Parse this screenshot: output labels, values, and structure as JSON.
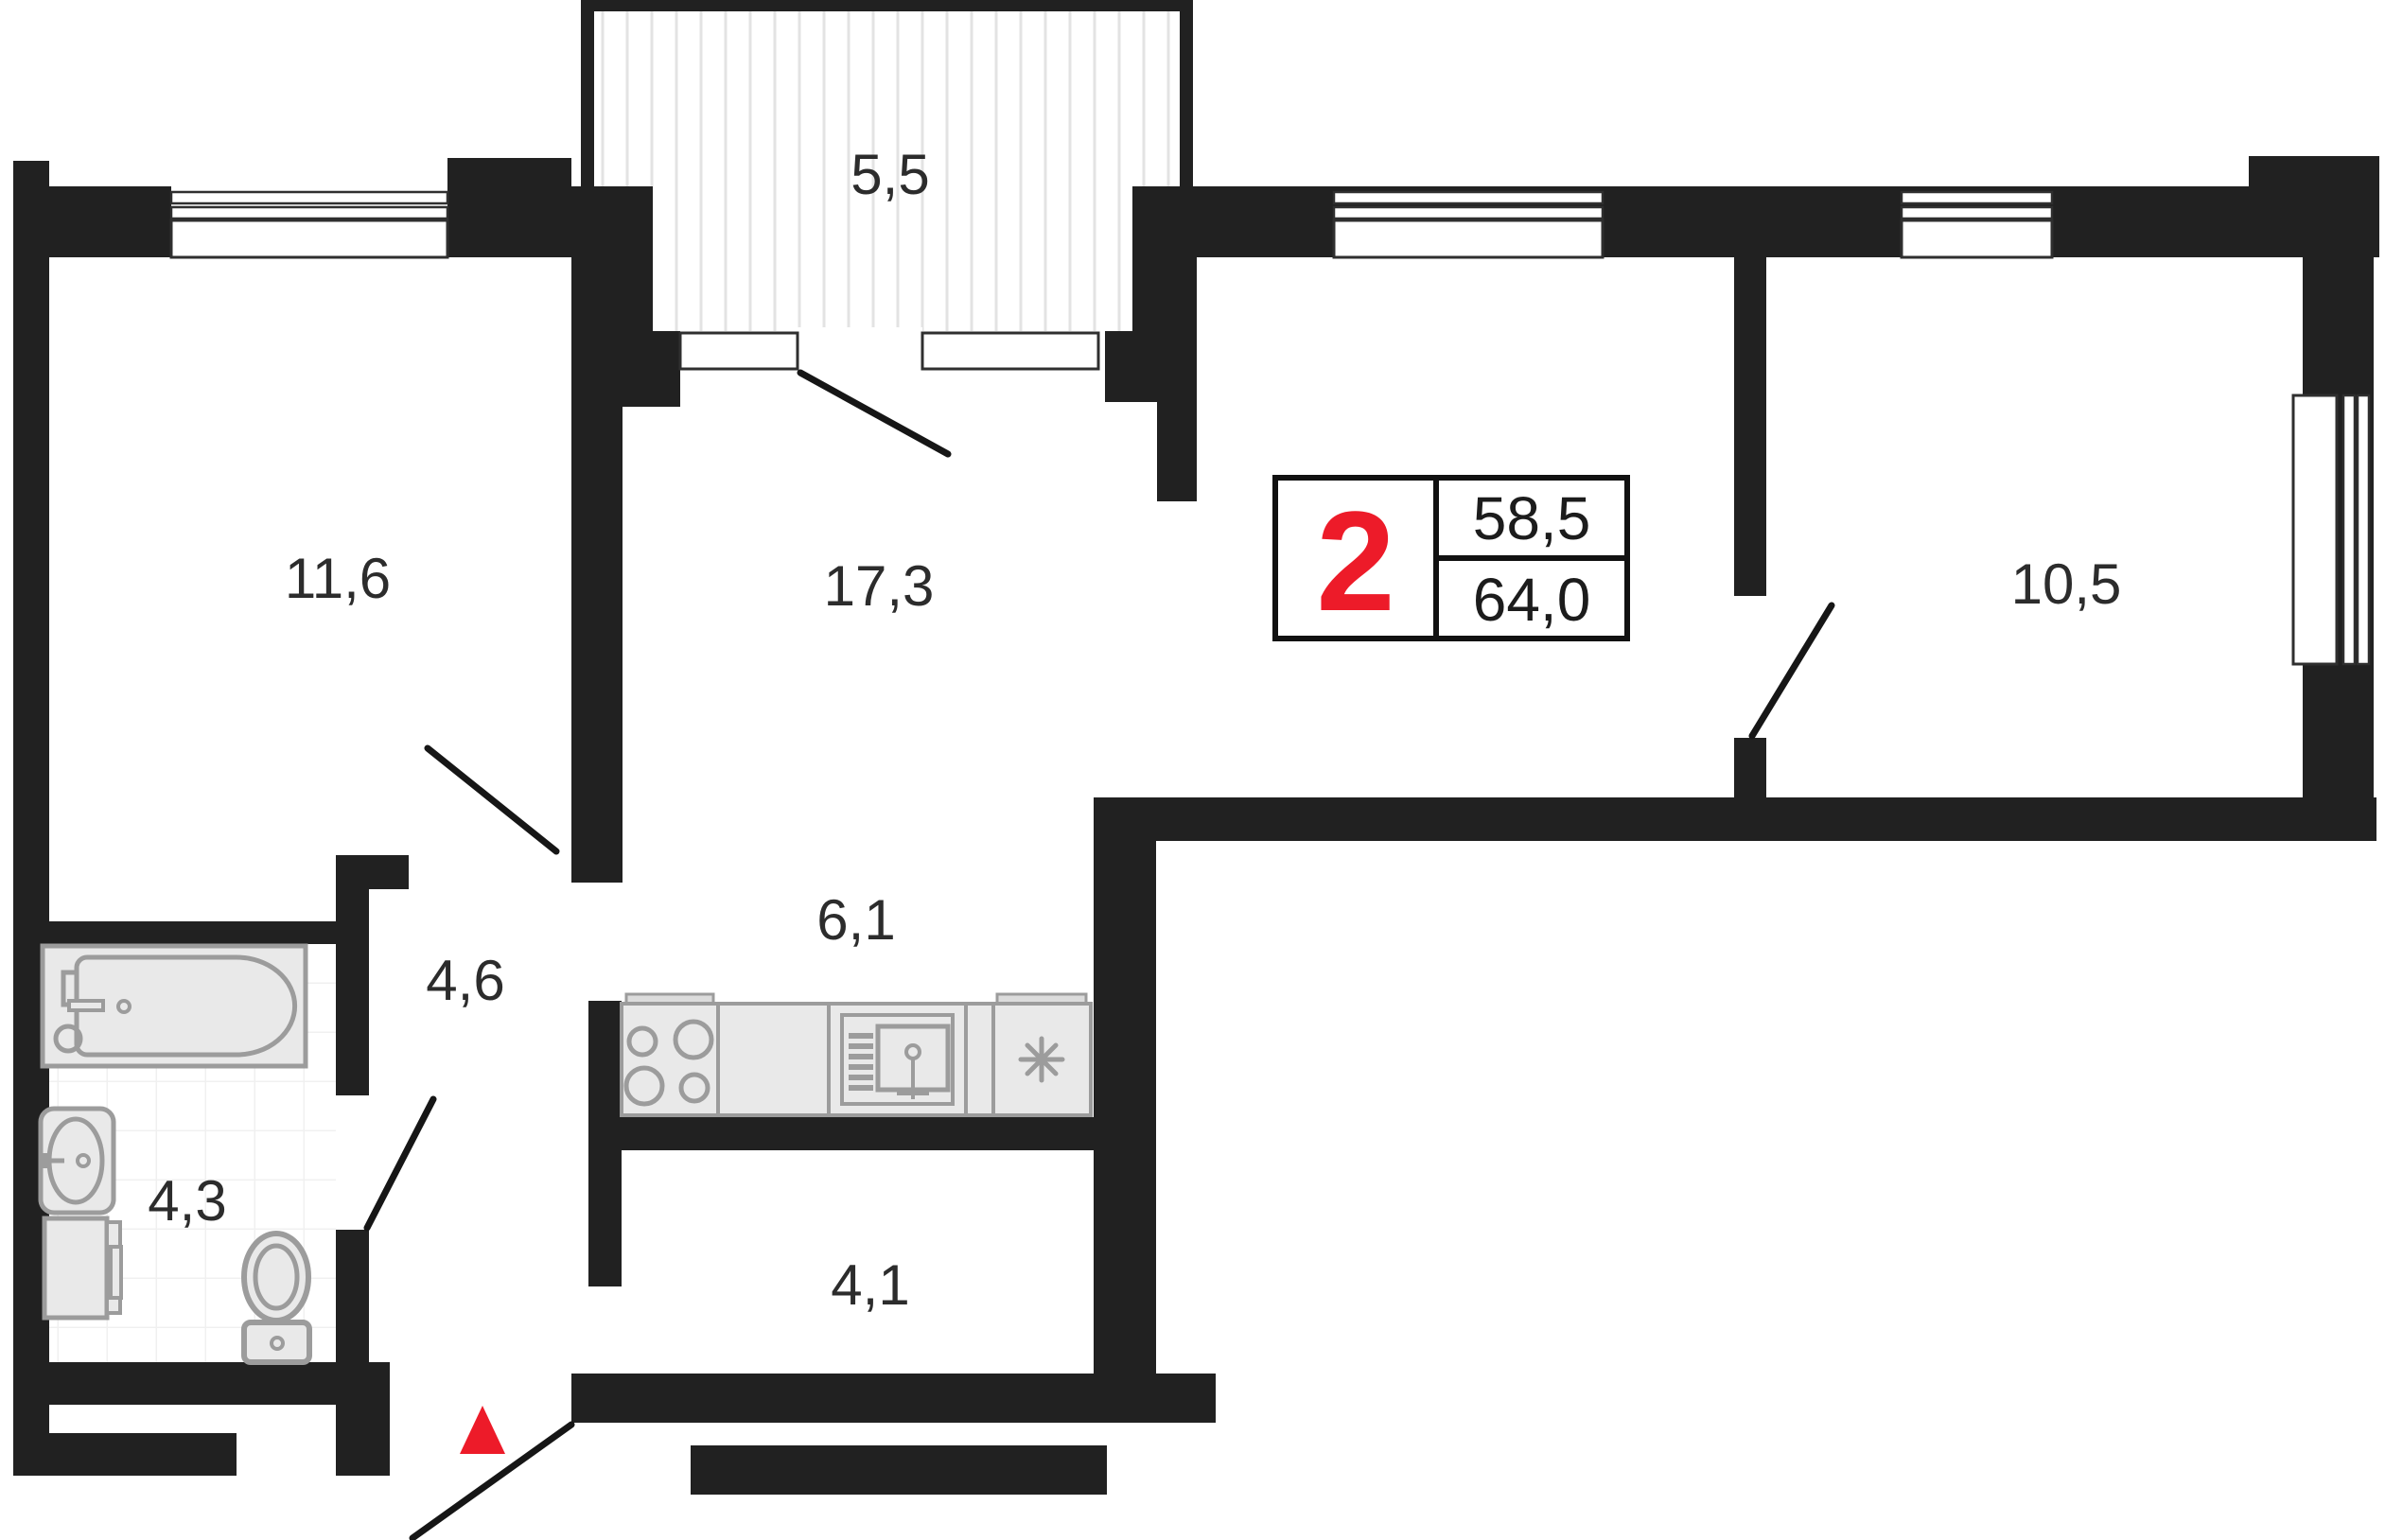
{
  "plan": {
    "title": "2-room apartment floor plan",
    "info_box": {
      "rooms_count": "2",
      "area_living": "58,5",
      "area_total": "64,0"
    },
    "rooms": [
      {
        "id": "bedroom",
        "label": "11,6"
      },
      {
        "id": "living-room",
        "label": "17,3"
      },
      {
        "id": "balcony",
        "label": "5,5"
      },
      {
        "id": "bedroom-2",
        "label": "10,5"
      },
      {
        "id": "hallway",
        "label": "6,1"
      },
      {
        "id": "corridor",
        "label": "4,6"
      },
      {
        "id": "bathroom",
        "label": "4,3"
      },
      {
        "id": "entry-hall",
        "label": "4,1"
      }
    ],
    "colors": {
      "wall": "#212121",
      "accent_red": "#ed1b29",
      "fixture_fill": "#e9e9e9",
      "fixture_stroke": "#9c9c9c",
      "hatch_line": "#e3e3e3",
      "tile_line": "#f0f0f0",
      "window_outline": "#2f2f2f"
    },
    "icons": {
      "entrance_marker": "red-triangle-up",
      "fridge_symbol": "snowflake-asterisk",
      "stove": "four-burner-circles",
      "kitchen_sink": "sink-with-faucet",
      "bathtub": "bathtub-left-faucet",
      "wash_basin": "oval-basin",
      "washing_machine": "front-load-box",
      "toilet": "toilet-with-tank",
      "doors": "door-swing-lines"
    }
  }
}
